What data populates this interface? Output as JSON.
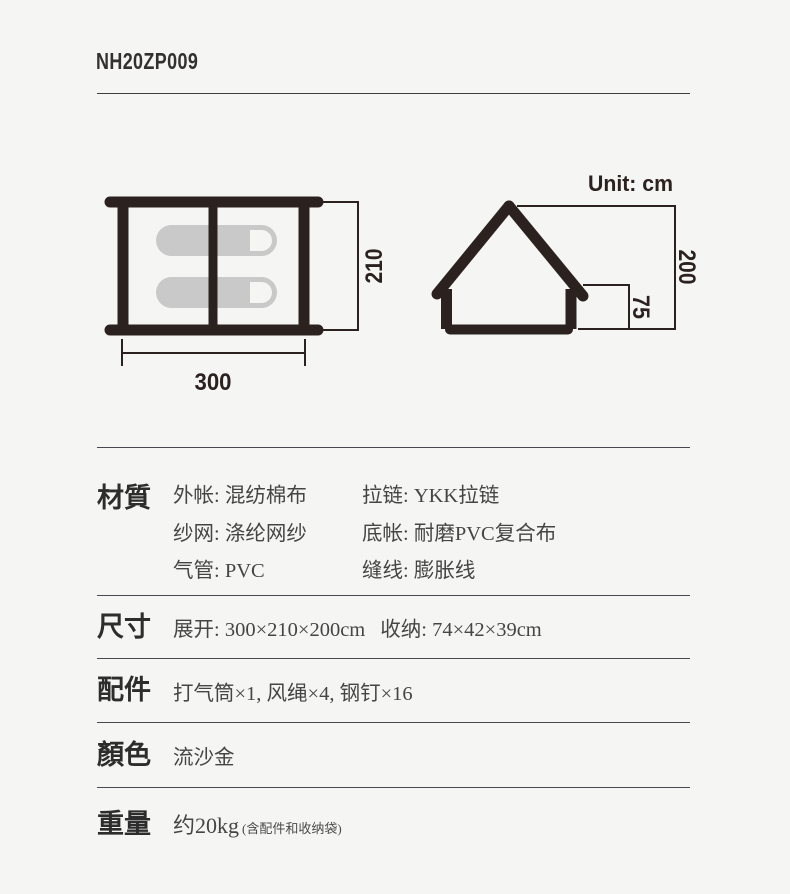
{
  "header": {
    "product_code": "NH20ZP009"
  },
  "diagrams": {
    "unit_label": "Unit: cm",
    "top_view": {
      "width": "300",
      "depth": "210"
    },
    "side_view": {
      "peak_height": "200",
      "wall_height": "75"
    }
  },
  "specs": {
    "material": {
      "label": "材質",
      "col1": [
        "外帐: 混纺棉布",
        "纱网: 涤纶网纱",
        "气管: PVC"
      ],
      "col2": [
        "拉链: YKK拉链",
        "底帐: 耐磨PVC复合布",
        "缝线: 膨胀线"
      ]
    },
    "size": {
      "label": "尺寸",
      "expanded": "展开: 300×210×200cm",
      "packed": "收纳: 74×42×39cm"
    },
    "accessories": {
      "label": "配件",
      "value": "打气筒×1, 风绳×4, 钢钉×16"
    },
    "color": {
      "label": "顏色",
      "value": "流沙金"
    },
    "weight": {
      "label": "重量",
      "value": "约20kg",
      "note": "(含配件和收纳袋)"
    }
  },
  "colors": {
    "background": "#f5f5f3",
    "diagram_ink": "#2b2220",
    "pad_fill": "#c9c9c9",
    "rule": "#47474f",
    "text": "#454545"
  }
}
